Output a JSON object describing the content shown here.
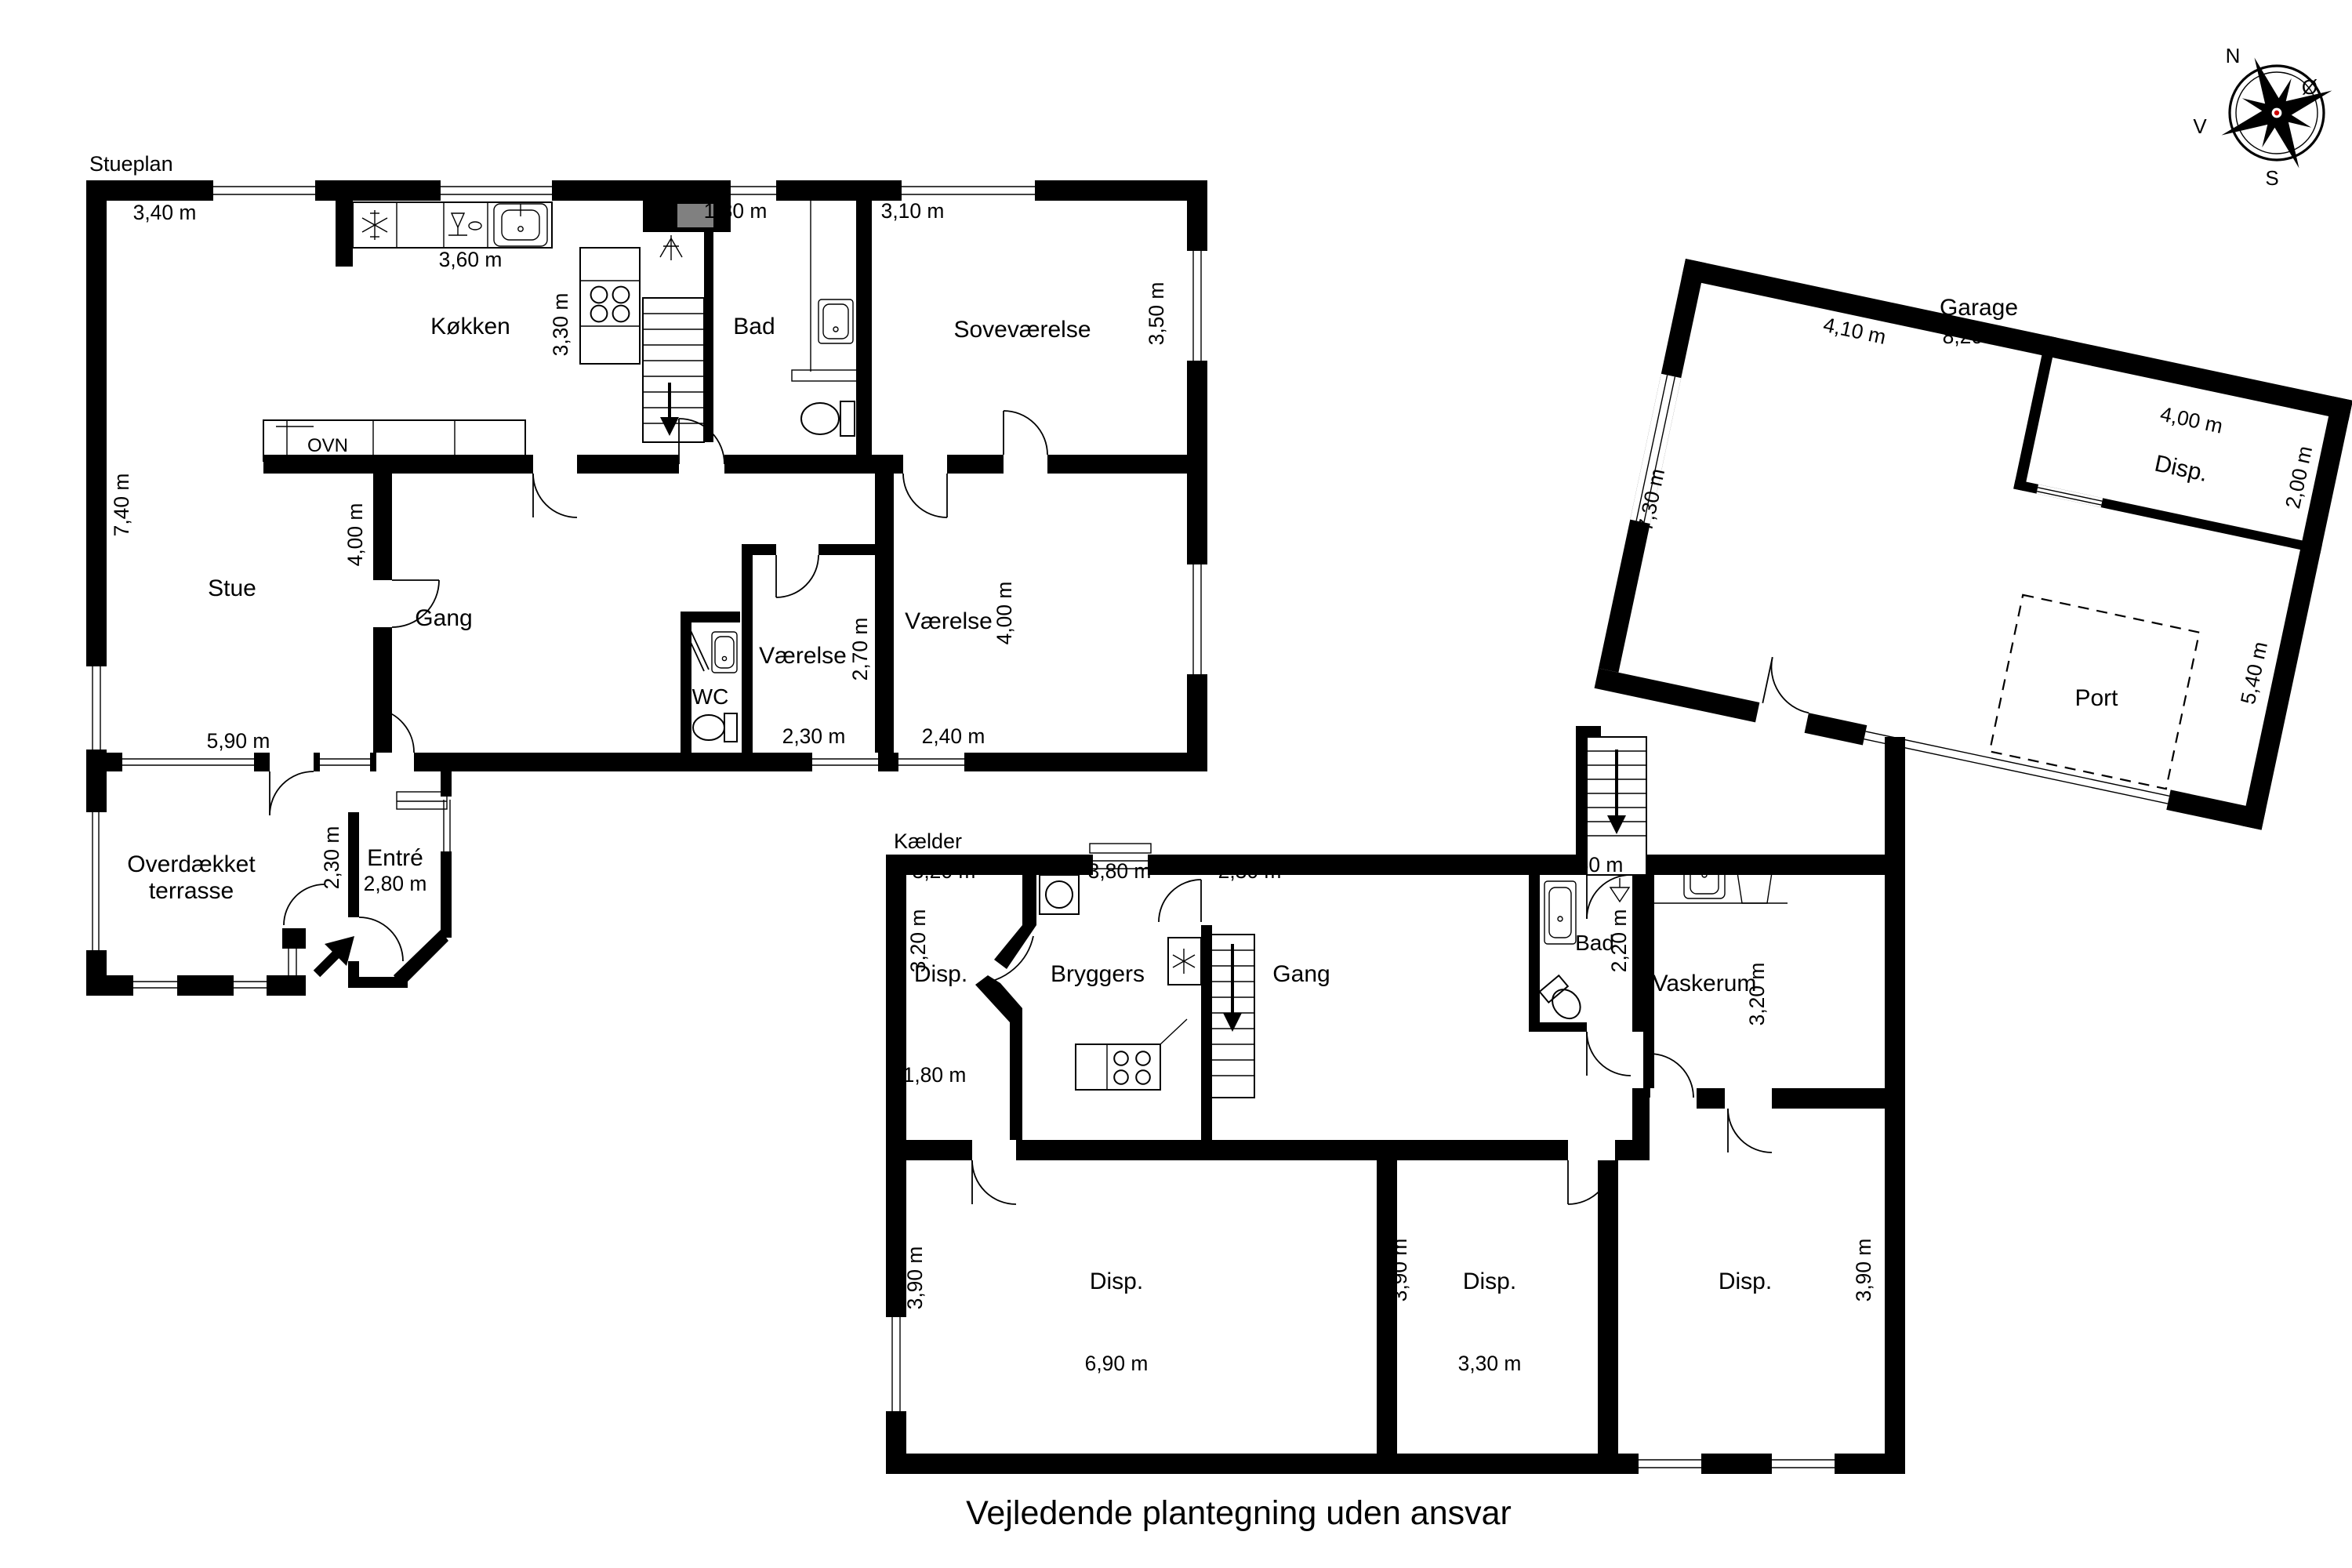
{
  "caption": "Vejledende plantegning uden ansvar",
  "compass": {
    "n": "N",
    "e": "Ø",
    "s": "S",
    "v": "V"
  },
  "stueplan": {
    "title": "Stueplan",
    "rooms": {
      "kokken": "Køkken",
      "bad": "Bad",
      "sovevaerelse": "Soveværelse",
      "stue": "Stue",
      "gang": "Gang",
      "vaerelse1": "Værelse",
      "vaerelse2": "Værelse",
      "wc": "WC",
      "terrasse1": "Overdækket",
      "terrasse2": "terrasse",
      "entre": "Entré",
      "ovn": "OVN"
    },
    "dims": {
      "d340": "3,40 m",
      "d360": "3,60 m",
      "d330": "3,30 m",
      "d180": "1,80 m",
      "d310": "3,10 m",
      "d350": "3,50 m",
      "d740": "7,40 m",
      "d400g": "4,00 m",
      "d270": "2,70 m",
      "d230v": "2,30 m",
      "d400v": "4,00 m",
      "d240": "2,40 m",
      "d590": "5,90 m",
      "d230e": "2,30 m",
      "d280": "2,80 m"
    }
  },
  "kaelder": {
    "title": "Kælder",
    "rooms": {
      "disp1": "Disp.",
      "bryggers": "Bryggers",
      "gang": "Gang",
      "bad": "Bad",
      "vaskerum": "Vaskerum",
      "disp2": "Disp.",
      "disp3": "Disp.",
      "disp4": "Disp."
    },
    "dims": {
      "k320a": "3,20 m",
      "k380": "3,80 m",
      "k230": "2,30 m",
      "k150": "1,50 m",
      "k320l": "3,20 m",
      "k220": "2,20 m",
      "k320r": "3,20 m",
      "k180": "1,80 m",
      "k390l": "3,90 m",
      "k390m": "3,90 m",
      "k390r": "3,90 m",
      "k690": "6,90 m",
      "k330": "3,30 m"
    }
  },
  "garage": {
    "rooms": {
      "garage": "Garage",
      "disp": "Disp.",
      "port": "Port"
    },
    "dims": {
      "g410": "4,10 m",
      "g400": "4,00 m",
      "g200": "2,00 m",
      "g730": "7,30 m",
      "g820": "8,20 m",
      "g540": "5,40 m"
    }
  },
  "colors": {
    "wall": "#000000",
    "chimney": "#808080",
    "compass_center": "#cc0000",
    "background": "#ffffff"
  }
}
